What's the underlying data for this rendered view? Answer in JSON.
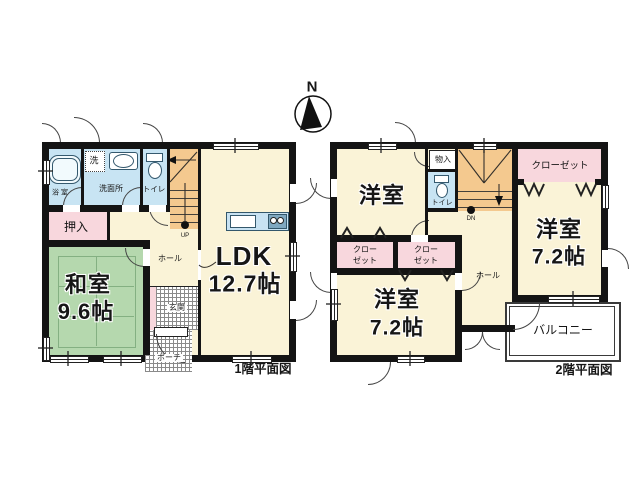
{
  "compass": {
    "north": "N"
  },
  "floor1": {
    "caption": "1階平面図",
    "bath": "浴 室",
    "washer": "洗",
    "washroom": "洗面所",
    "toilet": "トイレ",
    "stairs_up": "UP",
    "ldk_name": "LDK",
    "ldk_size": "12.7帖",
    "oshiire": "押入",
    "washitsu_name": "和室",
    "washitsu_size": "9.6帖",
    "hall": "ホール",
    "entrance": "玄関",
    "porch": "ポーチ"
  },
  "floor2": {
    "caption": "2階平面図",
    "room_top_left": "洋室",
    "storage": "物入",
    "toilet": "トイレ",
    "stairs_down": "DN",
    "closet_top": "クローゼット",
    "room_right_name": "洋室",
    "room_right_size": "7.2帖",
    "closet_a_line1": "クロー",
    "closet_a_line2": "ゼット",
    "closet_b_line1": "クロー",
    "closet_b_line2": "ゼット",
    "room_bottom_name": "洋室",
    "room_bottom_size": "7.2帖",
    "hall": "ホール",
    "balcony": "バルコニー"
  },
  "colors": {
    "wall": "#141414",
    "floor": "#faf3d7",
    "tatami": "#b5d8ae",
    "water": "#c8e4f3",
    "closet_pink": "#f8d7dd",
    "stairs": "#f4c98f",
    "kitchen": "#c8e2f2"
  }
}
